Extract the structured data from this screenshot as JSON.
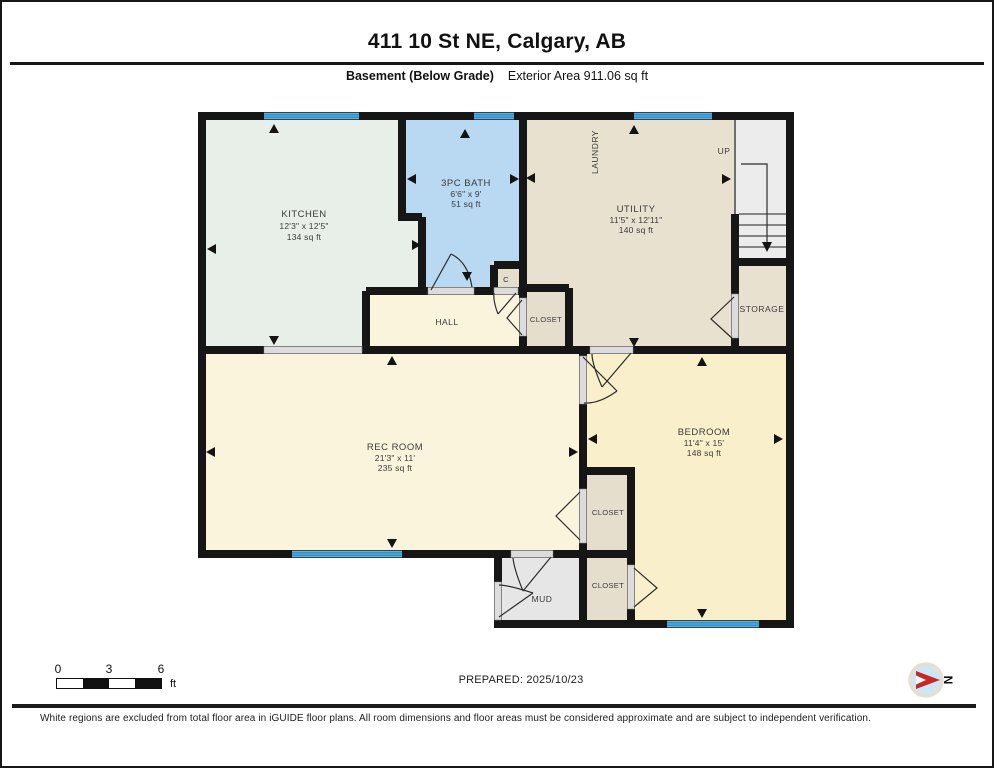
{
  "header": {
    "title": "411 10 St NE, Calgary, AB",
    "floor_label": "Basement (Below Grade)",
    "exterior_area_label": "Exterior Area 911.06 sq ft"
  },
  "rooms": {
    "kitchen": {
      "name": "KITCHEN",
      "dims": "12'3\" x 12'5\"",
      "area": "134 sq ft"
    },
    "bath": {
      "name": "3PC BATH",
      "dims": "6'6\" x 9'",
      "area": "51 sq ft"
    },
    "utility": {
      "name": "UTILITY",
      "dims": "11'5\" x 12'11\"",
      "area": "140 sq ft"
    },
    "laundry": {
      "name": "LAUNDRY"
    },
    "stairs": {
      "up_label": "UP"
    },
    "storage": {
      "name": "STORAGE"
    },
    "hall": {
      "name": "HALL"
    },
    "closet_c": {
      "name": "C"
    },
    "closet_hall": {
      "name": "CLOSET"
    },
    "rec_room": {
      "name": "REC ROOM",
      "dims": "21'3\" x 11'",
      "area": "235 sq ft"
    },
    "bedroom": {
      "name": "BEDROOM",
      "dims": "11'4\" x 15'",
      "area": "148 sq ft"
    },
    "closet_rec": {
      "name": "CLOSET"
    },
    "closet_bedroom": {
      "name": "CLOSET"
    },
    "mud": {
      "name": "MUD"
    }
  },
  "scale_bar": {
    "tick0": "0",
    "tick3": "3",
    "tick6": "6",
    "unit": "ft"
  },
  "footer": {
    "prepared": "PREPARED: 2025/10/23",
    "compass_label": "N",
    "disclaimer": "White regions are excluded from total floor area in iGUIDE floor plans. All room dimensions and floor areas must be considered approximate and are subject to independent verification."
  },
  "colors": {
    "kitchen": "#e7efe8",
    "bath": "#b8d9f1",
    "utility": "#e9e1cf",
    "cream": "#fbf4dc",
    "bedroom": "#f9efca",
    "closet": "#e6decd",
    "mud": "#e6e6e6",
    "stairs": "#ececec",
    "window": "#68b6e0"
  }
}
